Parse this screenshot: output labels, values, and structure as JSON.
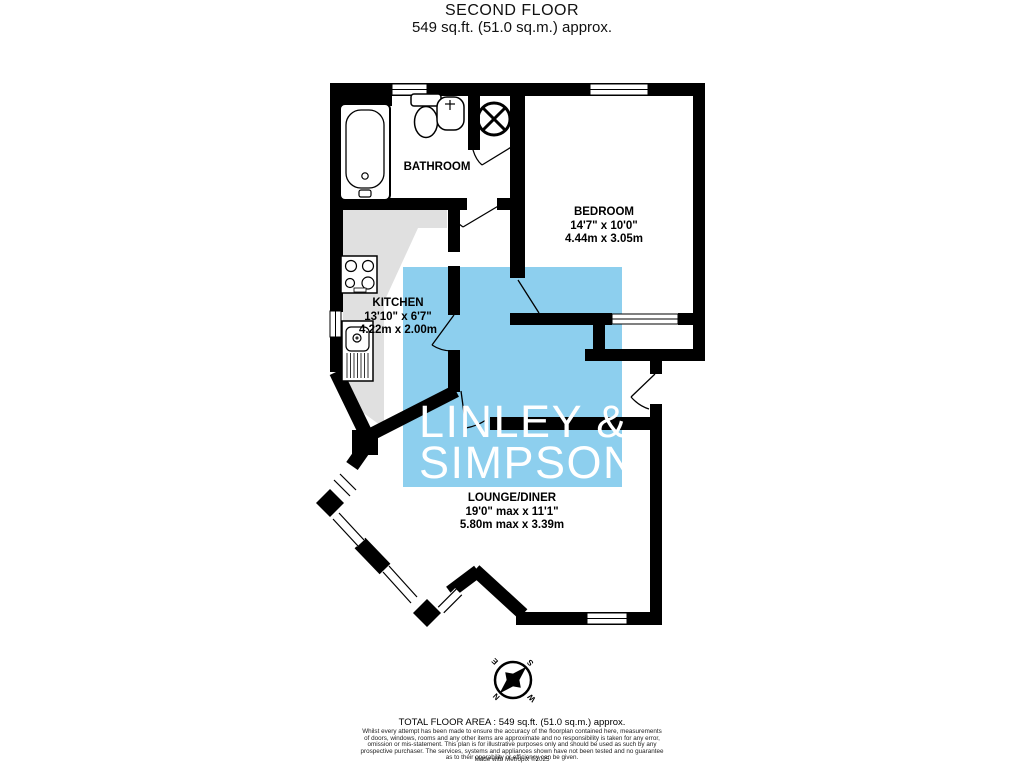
{
  "title": {
    "line1": "SECOND FLOOR",
    "line2": "549 sq.ft. (51.0 sq.m.) approx."
  },
  "rooms": {
    "bathroom": {
      "name": "BATHROOM"
    },
    "bedroom": {
      "name": "BEDROOM",
      "dims_imperial": "14'7\" x 10'0\"",
      "dims_metric": "4.44m x 3.05m"
    },
    "kitchen": {
      "name": "KITCHEN",
      "dims_imperial": "13'10\" x 6'7\"",
      "dims_metric": "4.22m x 2.00m"
    },
    "lounge": {
      "name": "LOUNGE/DINER",
      "dims_imperial": "19'0\" max x 11'1\"",
      "dims_metric": "5.80m max x 3.39m"
    }
  },
  "watermark": {
    "line1": "LINLEY &",
    "line2": "SIMPSON",
    "square_color": "#8DCFEE",
    "text_color": "#FFFFFF"
  },
  "compass": {
    "n": "N",
    "e": "E",
    "s": "S",
    "w": "W"
  },
  "colors": {
    "wall": "#000000",
    "counter_gray": "#E0E0E0"
  },
  "footer": {
    "total": "TOTAL FLOOR AREA : 549 sq.ft. (51.0 sq.m.) approx.",
    "disclaimer_lines": [
      "Whilst every attempt has been made to ensure the accuracy of the floorplan contained here, measurements",
      "of doors, windows, rooms and any other items are approximate and no responsibility is taken for any error,",
      "omission or mis-statement. This plan is for illustrative purposes only and should be used as such by any",
      "prospective purchaser. The services, systems and appliances shown have not been tested and no guarantee",
      "as to their operability or efficiency can be given."
    ],
    "credit": "Made with Metropix ©2025"
  }
}
